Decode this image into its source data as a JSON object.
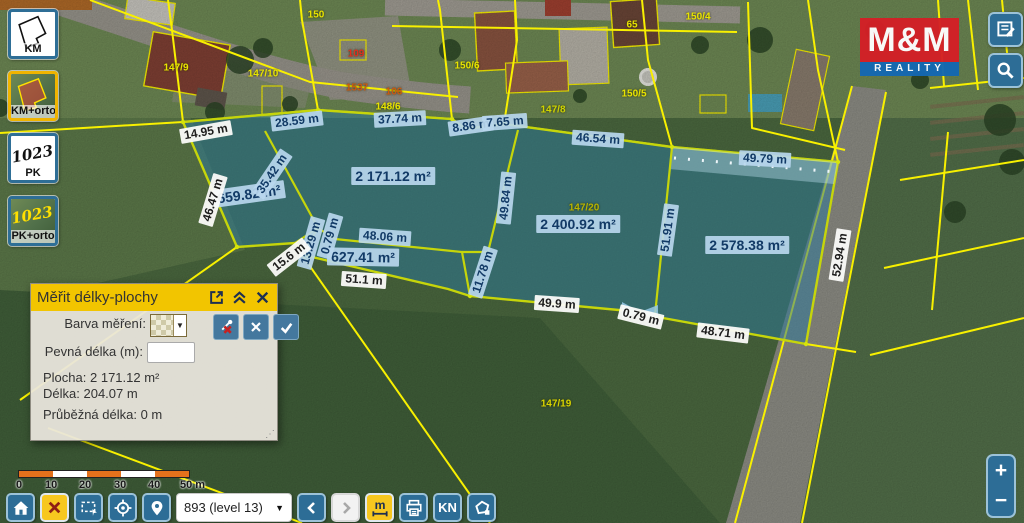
{
  "logo": {
    "top": "M&M",
    "bottom": "REALITY"
  },
  "sidebar": {
    "layers": [
      {
        "label": "KM",
        "selected": false
      },
      {
        "label": "KM+orto",
        "selected": true
      },
      {
        "label": "PK",
        "selected": false
      },
      {
        "label": "PK+orto",
        "selected": false
      }
    ],
    "pk_sketch_text": "1023"
  },
  "measure_panel": {
    "title": "Měřit délky-plochy",
    "color_label": "Barva měření:",
    "fixed_length_label": "Pevná délka (m):",
    "fixed_length_value": "",
    "stats": {
      "area_label": "Plocha:",
      "area_value": "2 171.12 m²",
      "length_label": "Délka:",
      "length_value": "204.07 m",
      "running_label": "Průběžná délka:",
      "running_value": "0 m"
    }
  },
  "map": {
    "measure_labels": [
      {
        "text": "14.95 m",
        "x": 206,
        "y": 132,
        "rot": -10,
        "style": "white"
      },
      {
        "text": "28.59 m",
        "x": 297,
        "y": 121,
        "rot": -7,
        "style": "blue"
      },
      {
        "text": "37.74 m",
        "x": 400,
        "y": 119,
        "rot": -3,
        "style": "blue"
      },
      {
        "text": "8.86 m",
        "x": 471,
        "y": 126,
        "rot": -8,
        "style": "blue"
      },
      {
        "text": "7.65 m",
        "x": 505,
        "y": 122,
        "rot": -4,
        "style": "blue"
      },
      {
        "text": "46.54 m",
        "x": 598,
        "y": 139,
        "rot": 4,
        "style": "blue"
      },
      {
        "text": "49.79 m",
        "x": 765,
        "y": 159,
        "rot": 3,
        "style": "blue"
      },
      {
        "text": "659.82 m²",
        "x": 249,
        "y": 194,
        "rot": -8,
        "style": "blue",
        "big": true
      },
      {
        "text": "2 171.12 m²",
        "x": 393,
        "y": 176,
        "rot": 0,
        "style": "blue",
        "big": true
      },
      {
        "text": "35.42 m",
        "x": 272,
        "y": 174,
        "rot": -56,
        "style": "blue"
      },
      {
        "text": "46.47 m",
        "x": 213,
        "y": 200,
        "rot": -73,
        "style": "white"
      },
      {
        "text": "49.84 m",
        "x": 506,
        "y": 198,
        "rot": -84,
        "style": "blue"
      },
      {
        "text": "48.06 m",
        "x": 385,
        "y": 237,
        "rot": 4,
        "style": "blue"
      },
      {
        "text": "627.41 m²",
        "x": 363,
        "y": 257,
        "rot": 1,
        "style": "blue",
        "big": true
      },
      {
        "text": "51.1 m",
        "x": 364,
        "y": 280,
        "rot": 4,
        "style": "white"
      },
      {
        "text": "13.29 m",
        "x": 311,
        "y": 243,
        "rot": -74,
        "style": "blue"
      },
      {
        "text": "0.79 m",
        "x": 330,
        "y": 236,
        "rot": -74,
        "style": "blue"
      },
      {
        "text": "15.6 m",
        "x": 289,
        "y": 257,
        "rot": -38,
        "style": "white"
      },
      {
        "text": "11.78 m",
        "x": 483,
        "y": 272,
        "rot": -72,
        "style": "blue"
      },
      {
        "text": "2 400.92 m²",
        "x": 578,
        "y": 224,
        "rot": 0,
        "style": "blue",
        "big": true
      },
      {
        "text": "51.91 m",
        "x": 668,
        "y": 230,
        "rot": -82,
        "style": "blue"
      },
      {
        "text": "49.9 m",
        "x": 557,
        "y": 304,
        "rot": 4,
        "style": "white"
      },
      {
        "text": "0.79 m",
        "x": 641,
        "y": 317,
        "rot": 14,
        "style": "white"
      },
      {
        "text": "48.71 m",
        "x": 723,
        "y": 333,
        "rot": 7,
        "style": "white"
      },
      {
        "text": "52.94 m",
        "x": 840,
        "y": 255,
        "rot": -81,
        "style": "white"
      },
      {
        "text": "2 578.38 m²",
        "x": 747,
        "y": 245,
        "rot": 0,
        "style": "blue",
        "big": true
      }
    ],
    "parcel_labels": [
      {
        "text": "147/9",
        "x": 176,
        "y": 68,
        "color": "#e8e400"
      },
      {
        "text": "147/10",
        "x": 263,
        "y": 74,
        "color": "#e8e400"
      },
      {
        "text": "150/6",
        "x": 467,
        "y": 66,
        "color": "#e8e400"
      },
      {
        "text": "65",
        "x": 632,
        "y": 25,
        "color": "#e8e400"
      },
      {
        "text": "150/4",
        "x": 698,
        "y": 17,
        "color": "#e8e400"
      },
      {
        "text": "150/5",
        "x": 634,
        "y": 94,
        "color": "#e8e400"
      },
      {
        "text": "147/8",
        "x": 553,
        "y": 110,
        "color": "#cfd400"
      },
      {
        "text": "148/6",
        "x": 388,
        "y": 107,
        "color": "#e8e400"
      },
      {
        "text": "150",
        "x": 316,
        "y": 15,
        "color": "#e8e400"
      },
      {
        "text": "1537",
        "x": 357,
        "y": 88,
        "color": "#cc5a10"
      },
      {
        "text": "106",
        "x": 394,
        "y": 92,
        "color": "#cc5a10"
      },
      {
        "text": "109",
        "x": 356,
        "y": 54,
        "color": "#e03020"
      },
      {
        "text": "147/20",
        "x": 584,
        "y": 208,
        "color": "#b8b400"
      },
      {
        "text": "147/19",
        "x": 556,
        "y": 404,
        "color": "#d8d400"
      }
    ]
  },
  "scalebar": {
    "ticks": [
      "0",
      "10",
      "20",
      "30",
      "40",
      "50 m"
    ]
  },
  "toolbar": {
    "level_value": "893 (level 13)",
    "kn_label": "KN",
    "measure_label": "m"
  },
  "zoom_control": {
    "plus": "+",
    "minus": "−"
  }
}
